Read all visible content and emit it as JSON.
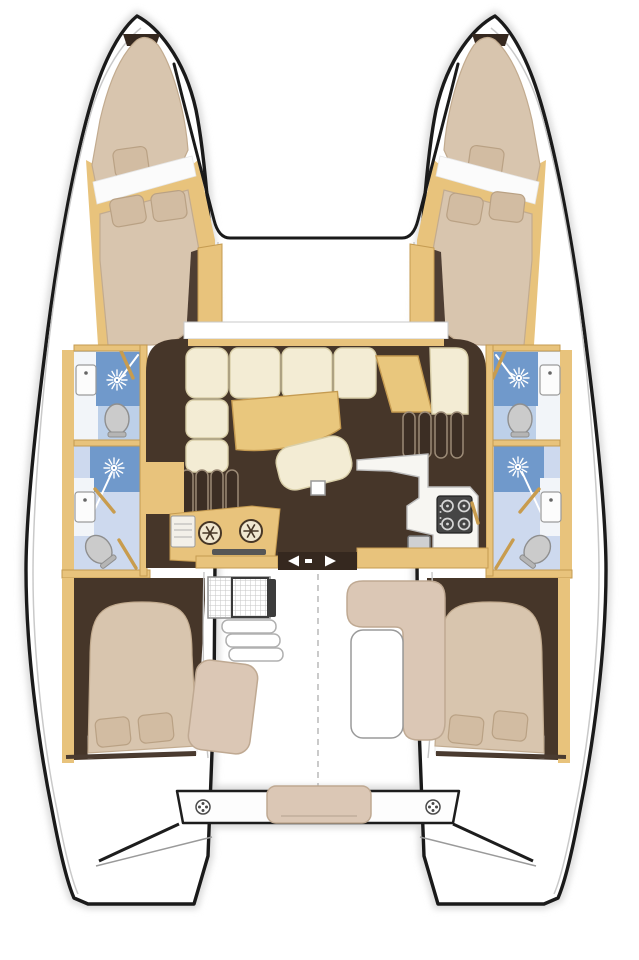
{
  "meta": {
    "description": "Top-view interior layout floor plan of a 4-cabin sailing catamaran",
    "visible_text": "none (diagram contains no readable text, only symbols)"
  },
  "colors": {
    "background": "#ffffff",
    "outline": "#1a1a1a",
    "deck-line": "#c9c9c9",
    "shadow": "#d9d9d9",
    "wood": "#e8c37c",
    "wood-dark": "#c59b51",
    "floor-dark": "#463629",
    "floor-darker": "#35281f",
    "mattress": "#d8c5ae",
    "mattress-stroke": "#c2ab8f",
    "pillow": "#d2bca2",
    "pillow-stroke": "#b9a184",
    "sheet-white": "#fbfbfb",
    "cream": "#f3ecd4",
    "cream-stroke": "#d9cfa9",
    "table-wood": "#e9c77d",
    "bath-bg": "#bdd0e9",
    "bath-floor": "#cdd9ee",
    "shower-blue": "#7099cb",
    "toilet-gray": "#cbcbcb",
    "toilet-stroke": "#8f8f8f",
    "counter-white": "#f7f6f2",
    "counter-stroke": "#bdbdbd",
    "stove-dark": "#454545",
    "burner": "#d6d6d6",
    "sink-gray": "#cfd0d2",
    "bench-beige": "#dbc7b5",
    "bench-stroke": "#bfa992",
    "door-gold": "#c89c4e",
    "step-dark": "#3c2e24",
    "step-stroke": "#9b8a76",
    "grid-line": "#c6c6c6"
  },
  "icons": {
    "shower_spray": "white starburst sprinkler symbol",
    "freezer_lid": "snowflake symbol in round lid",
    "cleat": "circle with four dots",
    "sliding_door_marker": "left/right white arrows",
    "stove": "four burner rings",
    "sink": "rectangle with faucet dot"
  },
  "features": {
    "hulls": [
      "port-hull",
      "starboard-hull"
    ],
    "forward": [
      "trampoline",
      "forepeak-berth-port",
      "forepeak-berth-starboard",
      "forward-cabin-port",
      "forward-cabin-starboard"
    ],
    "heads": [
      "head-forward-port",
      "head-aft-port",
      "head-forward-starboard",
      "head-aft-starboard"
    ],
    "saloon": [
      "l-shaped-sofa",
      "saloon-table",
      "ottoman",
      "nav-seat",
      "mast-post",
      "stairs-port",
      "stairs-starboard",
      "galley-counter",
      "stove",
      "galley-sink",
      "fridge-freezer-cabinet",
      "oven",
      "sliding-door"
    ],
    "aft": [
      "aft-cabin-port",
      "aft-cabin-starboard",
      "cockpit",
      "cockpit-table-port",
      "cockpit-steps",
      "cockpit-seat-port",
      "cockpit-bench-starboard",
      "cockpit-table-starboard",
      "aft-bench",
      "aft-crossbeam",
      "cleats",
      "transom-steps-port",
      "transom-steps-starboard"
    ]
  }
}
